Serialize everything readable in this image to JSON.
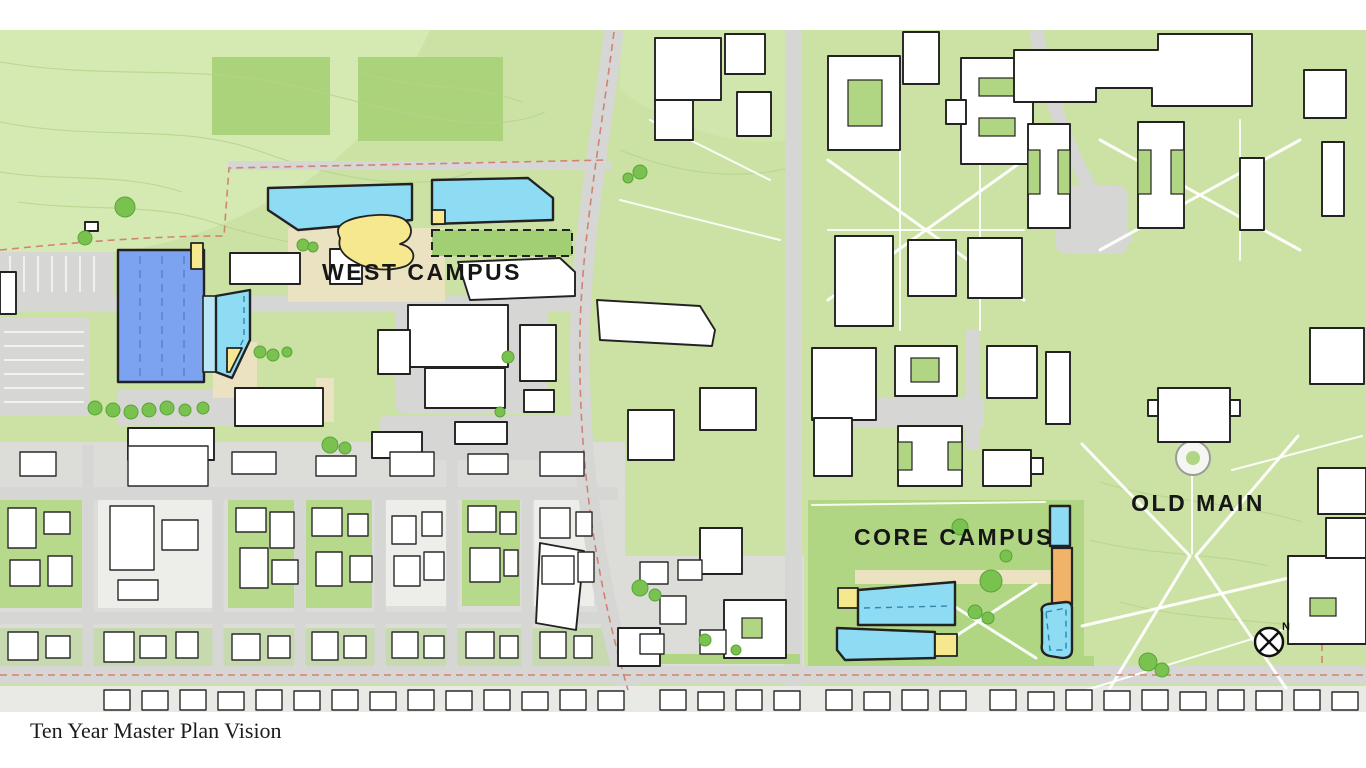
{
  "page": {
    "caption": "Ten Year Master Plan Vision"
  },
  "map": {
    "labels": {
      "west_campus": "WEST CAMPUS",
      "core_campus": "CORE CAMPUS",
      "old_main": "OLD MAIN"
    },
    "compass": {
      "north_label": "N"
    },
    "colors": {
      "base_green": "#cbe2a4",
      "light_green": "#d5e9b3",
      "field_green": "#aad37c",
      "lawn_green": "#b0d583",
      "block_green": "#b7d98c",
      "pale_block": "#ededea",
      "tree_green": "#79c24f",
      "tree_outline": "#58a436",
      "road_gray": "#d6d6d4",
      "town_gray": "#dcdcd9",
      "plaza_beige": "#ebe2c1",
      "building_white": "#ffffff",
      "building_outline": "#222222",
      "house_outline": "#2a2a2a",
      "proposed_blue": "#7ca3ef",
      "blue_dash": "#5d84cf",
      "proposed_cyan": "#8edbf4",
      "cyan_light": "#b9e7f6",
      "cyan_dash": "#2f86ad",
      "proposed_yellow": "#f6e88e",
      "proposed_orange": "#f1b369",
      "future_green": "#a2cf73",
      "boundary_red": "#cf7a6a",
      "contour_green": "#b6d28b",
      "path_white": "#ffffff",
      "label_ink": "#161616",
      "bottom_strip": "#e9e9e6"
    }
  }
}
